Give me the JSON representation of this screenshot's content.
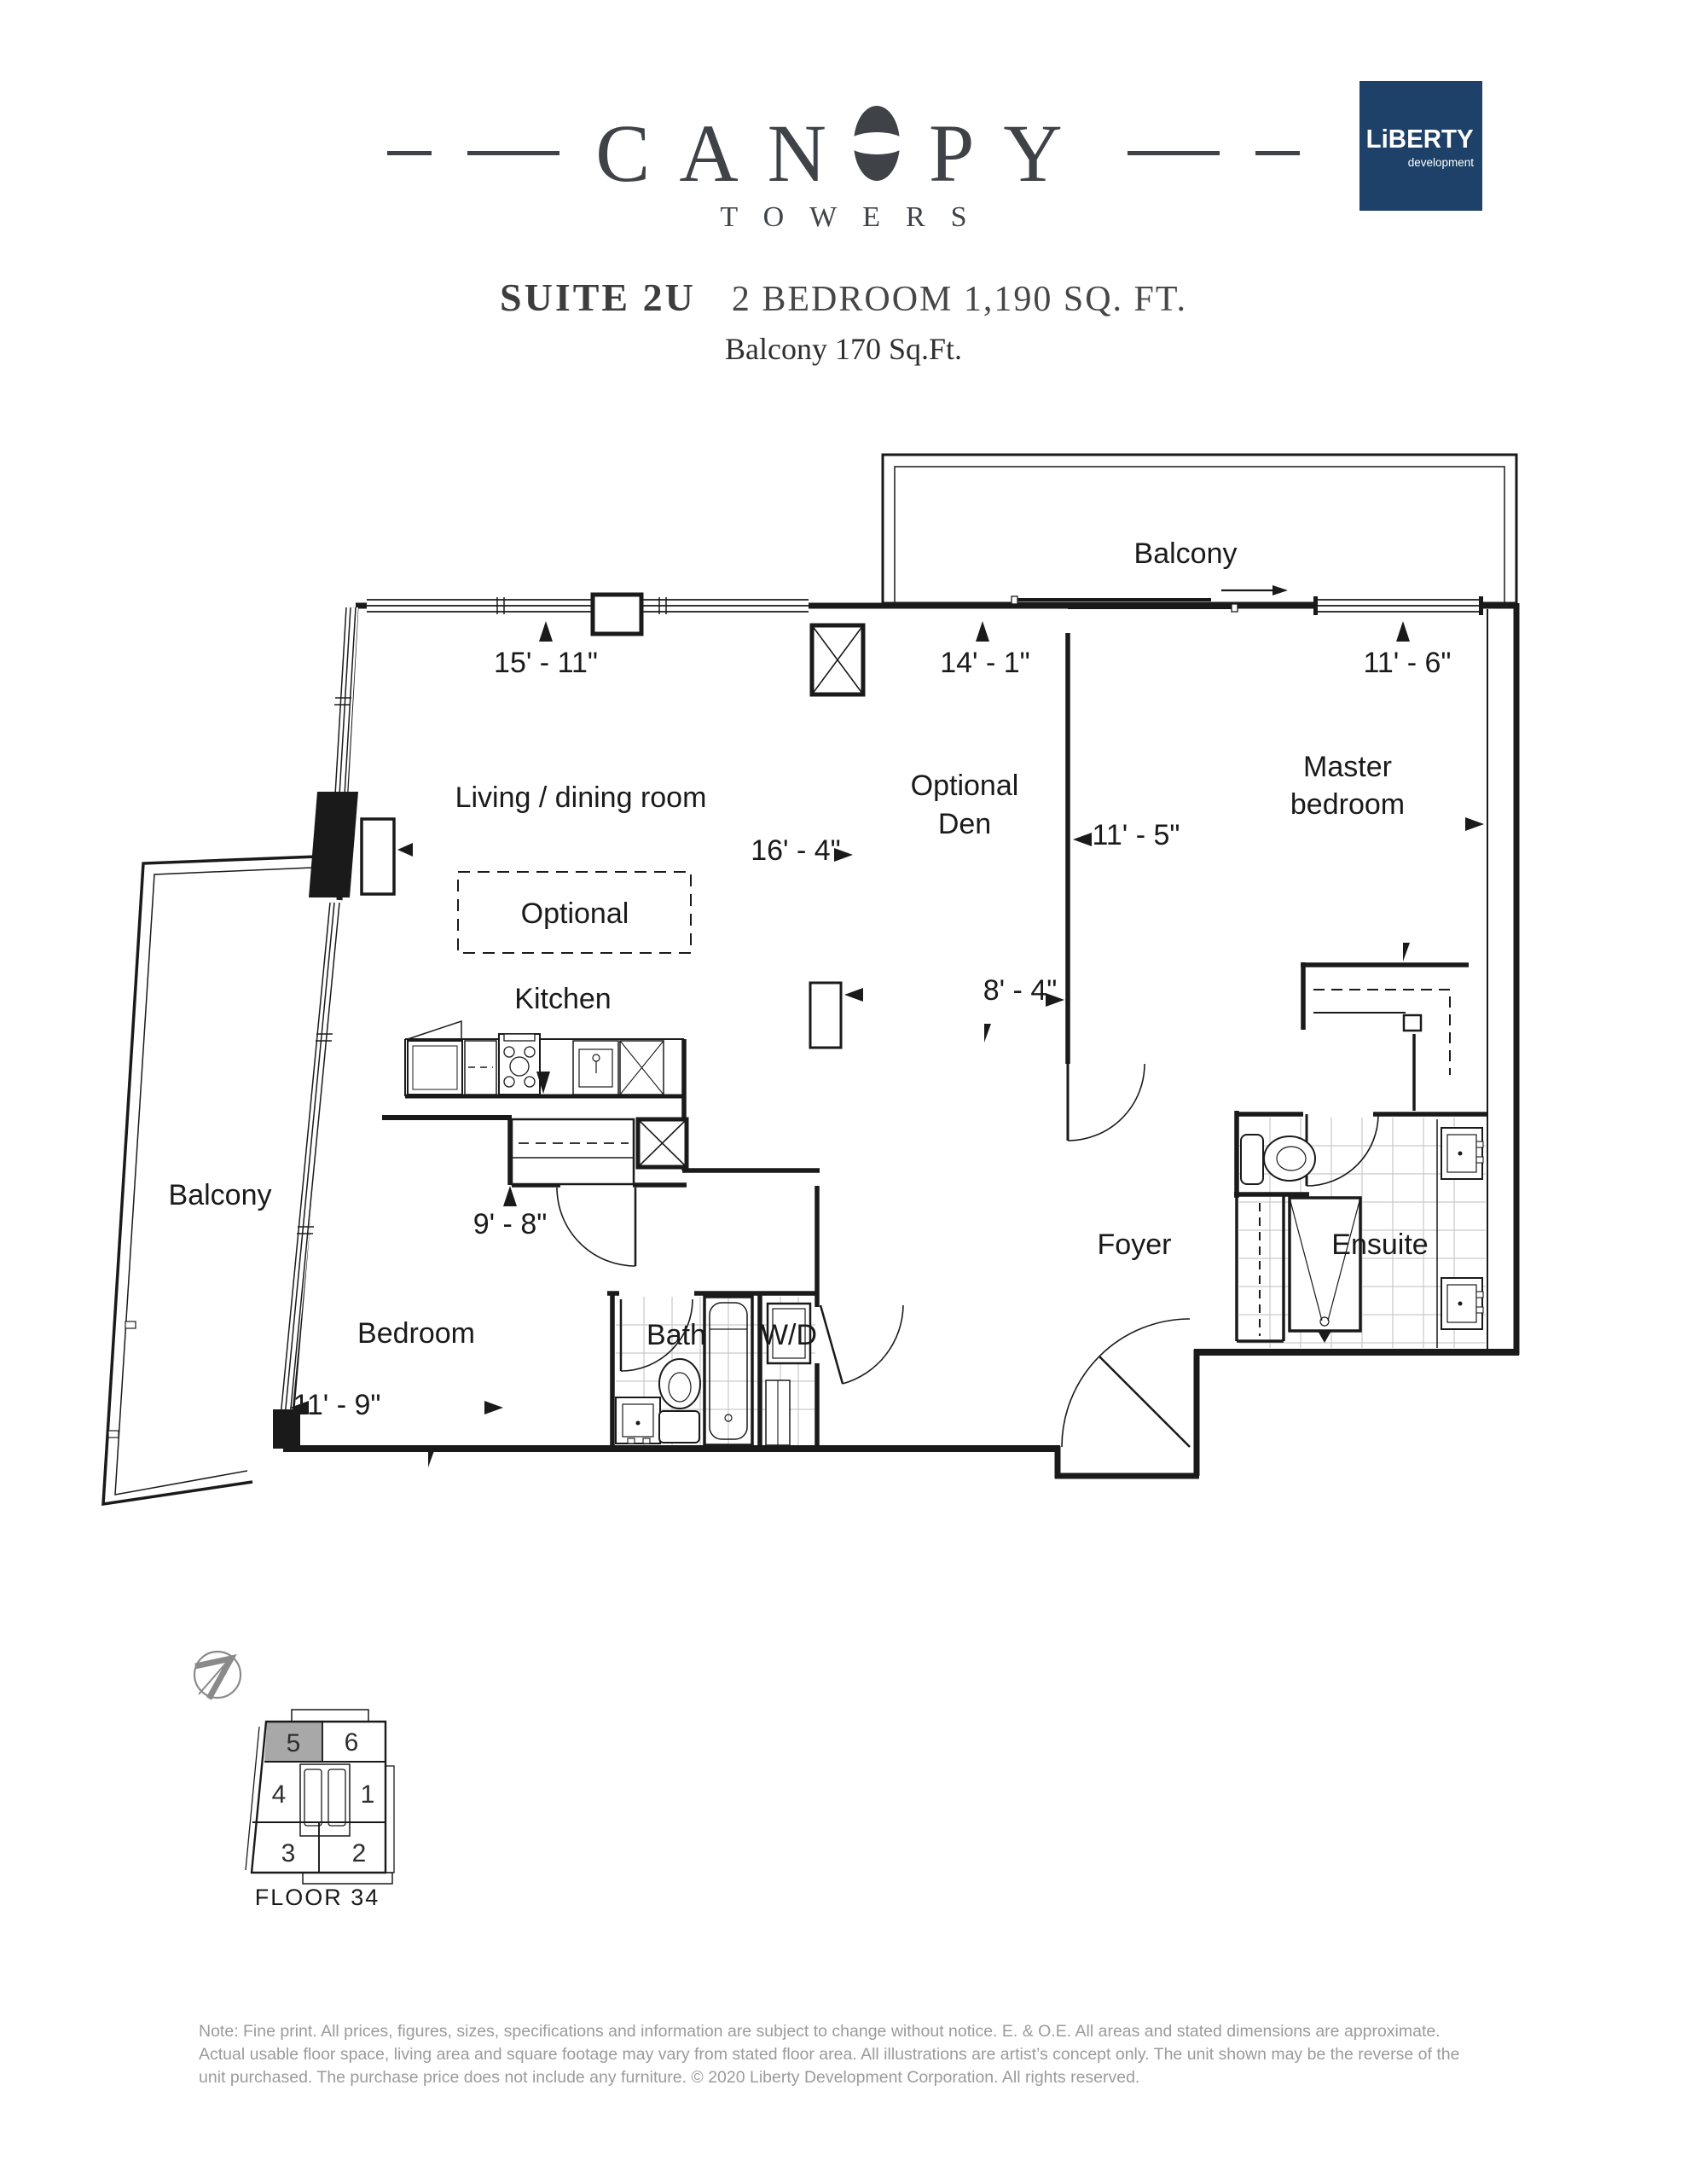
{
  "header": {
    "brand_name_left": "CAN",
    "brand_name_right": "PY",
    "brand_sub": "TOWERS",
    "liberty_logo": {
      "title": "LiBERTY",
      "subtitle": "development",
      "bg_color": "#1d4168"
    },
    "suite_label": "SUITE 2U",
    "suite_details": "2 BEDROOM 1,190 SQ. FT.",
    "balcony_details": "Balcony 170 Sq.Ft."
  },
  "floorplan": {
    "room_labels": {
      "balcony_top": "Balcony",
      "living": "Living / dining room",
      "optional_den_line1": "Optional",
      "optional_den_line2": "Den",
      "master_line1": "Master",
      "master_line2": "bedroom",
      "optional_kitchen": "Optional",
      "kitchen": "Kitchen",
      "balcony_left": "Balcony",
      "bedroom": "Bedroom",
      "bath": "Bath",
      "wd": "W/D",
      "foyer": "Foyer",
      "ensuite": "Ensuite"
    },
    "dimensions": {
      "living_top": "15' - 11\"",
      "den_top": "14' - 1\"",
      "master_top": "11' - 6\"",
      "living_width": "16' - 4\"",
      "master_width": "11' - 5\"",
      "den_width": "8' - 4\"",
      "kitchen_width": "9' - 8\"",
      "bedroom_width": "11' - 9\""
    }
  },
  "keyplan": {
    "floor_label": "FLOOR 34",
    "highlighted_unit": "5",
    "highlight_color": "#a8a8a8",
    "units": [
      {
        "number": "5"
      },
      {
        "number": "6"
      },
      {
        "number": "4"
      },
      {
        "number": "1"
      },
      {
        "number": "3"
      },
      {
        "number": "2"
      }
    ]
  },
  "footnote": {
    "line1": "Note: Fine print. All prices, figures, sizes, specifications and information are subject to change without notice.  E. & O.E. All areas and stated dimensions are approximate.",
    "line2": "Actual usable floor space, living area and square footage may vary from stated floor area. All illustrations are artist’s concept only. The unit shown may be the reverse of the",
    "line3": "unit purchased. The purchase price does not include any furniture. © 2020 Liberty Development Corporation. All rights reserved."
  },
  "colors": {
    "ink": "#1a1a1a",
    "title": "#3f4246",
    "navy": "#1d4168",
    "tile": "#c9c9c9",
    "fine_print": "#9b9b9b",
    "north_arrow": "#8a8a8a"
  }
}
